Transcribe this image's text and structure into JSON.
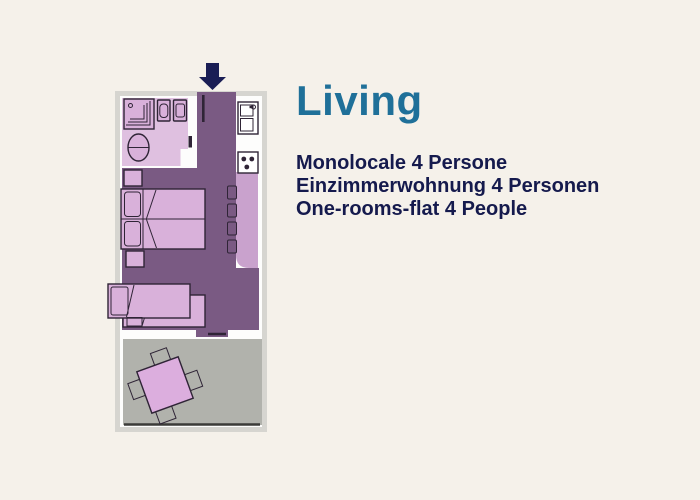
{
  "header": {
    "title": "Living"
  },
  "description": {
    "italian": "Monolocale 4 Persone",
    "german": "Einzimmerwohnung 4 Personen",
    "english": "One-rooms-flat 4 People"
  },
  "floorplan": {
    "type": "apartment-floor-plan",
    "depicted_elements": [
      "entrance-arrow",
      "bathroom: shower, sink, cistern, toilet",
      "kitchen: sink unit, stove with 3 burners, counter, 4 stools",
      "double bed with 2 pillows and 2 nightstands",
      "single sofa bed with pull-out section",
      "terrace: rotated square table with 4 chairs, railing"
    ]
  },
  "colors": {
    "background": "#f5f1ea",
    "title_teal": "#1f7099",
    "text_navy": "#151a4d",
    "arrow_navy": "#1a1e55",
    "plan_frame_gray": "#d6d5d0",
    "wall_white": "#fdfdfc",
    "floor_purple": "#7a5a83",
    "room_pink": "#dfc0e0",
    "furniture_pink": "#d9b1da",
    "pillow_pink": "#e3c8e4",
    "counter_purple": "#c9a2cd",
    "stool_pink": "#d2a8d4",
    "terrace_gray": "#b1b2ac",
    "table_pink": "#dcaede",
    "outline_dark": "#2f2436",
    "railing_dark": "#3b3b38"
  }
}
